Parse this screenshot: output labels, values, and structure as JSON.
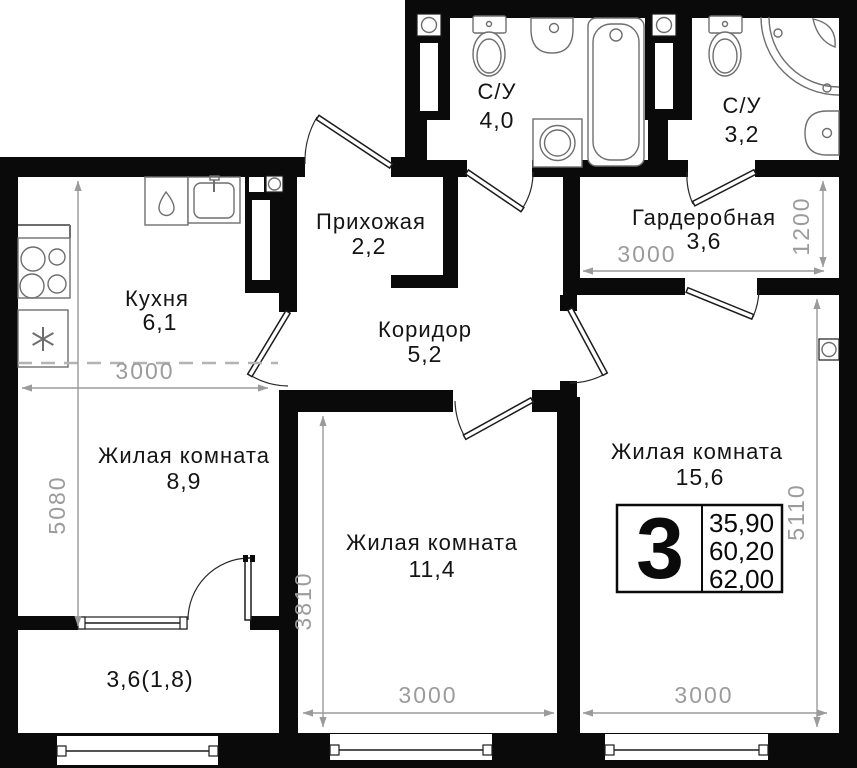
{
  "plan": {
    "background": "#ffffff",
    "colors": {
      "wall": "#0a0a0a",
      "dimension": "#9b9b9b",
      "fixture": "#6e6e6e",
      "text": "#141414"
    },
    "rooms": {
      "bath_4": {
        "label": "С/У",
        "area": "4,0"
      },
      "bath_3": {
        "label": "С/У",
        "area": "3,2"
      },
      "entry": {
        "label": "Прихожая",
        "area": "2,2"
      },
      "wardrobe": {
        "label": "Гардеробная",
        "area": "3,6"
      },
      "kitchen": {
        "label": "Кухня",
        "area": "6,1"
      },
      "corridor": {
        "label": "Коридор",
        "area": "5,2"
      },
      "living_8_9": {
        "label": "Жилая комната",
        "area": "8,9"
      },
      "living_11_4": {
        "label": "Жилая комната",
        "area": "11,4"
      },
      "living_15_6": {
        "label": "Жилая комната",
        "area": "15,6"
      },
      "balcony": {
        "area": "3,6(1,8)"
      }
    },
    "dimensions": {
      "kitchen_width": "3000",
      "left_zone_height": "5080",
      "wardrobe_width": "3000",
      "wardrobe_depth": "1200",
      "living_11_4_height": "3810",
      "living_11_4_width": "3000",
      "living_15_6_width": "3000",
      "living_15_6_height": "5110"
    },
    "info_badge": {
      "room_count": "3",
      "living_area": "35,90",
      "usable_area": "60,20",
      "total_area": "62,00"
    },
    "fixtures": {
      "bath_4": [
        "toilet-icon",
        "washbasin-icon",
        "bathtub-icon",
        "washing-machine-icon",
        "vent-icon"
      ],
      "bath_3": [
        "toilet-icon",
        "corner-shower-icon",
        "washbasin-icon",
        "vent-icon"
      ],
      "kitchen": [
        "stove-icon",
        "fridge-icon",
        "kitchen-sink-icon",
        "dishwasher-icon",
        "vent-icon"
      ],
      "living_15_6": [
        "vent-icon"
      ]
    }
  }
}
